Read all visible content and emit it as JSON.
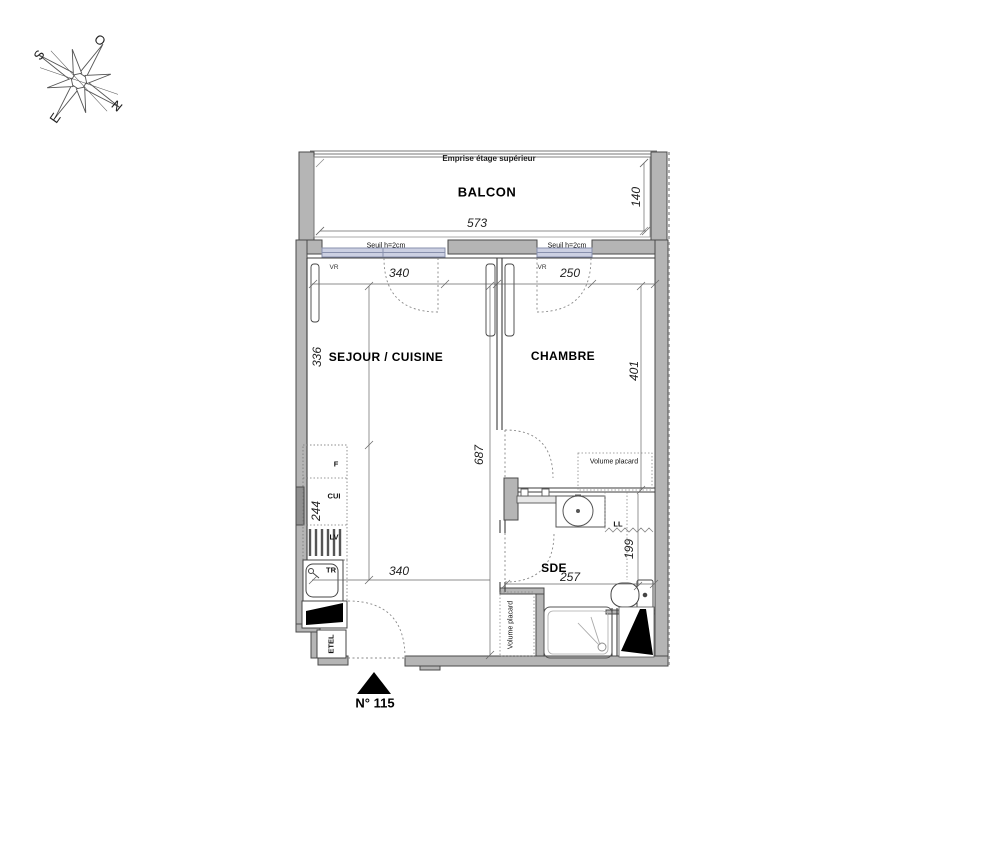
{
  "compass": {
    "n": "N",
    "s": "S",
    "e": "E",
    "o": "O"
  },
  "labels": {
    "upper_floor": "Emprise étage supérieur",
    "balcony": "BALCON",
    "threshold_left": "Seuil h=2cm",
    "threshold_right": "Seuil h=2cm",
    "shutter_left": "VR",
    "shutter_right": "VR",
    "living": "SEJOUR / CUISINE",
    "bedroom": "CHAMBRE",
    "bathroom": "SDE",
    "fridge": "F",
    "kitchen": "CUI",
    "dishwasher": "LV",
    "sink_unit": "TR",
    "washer": "LL",
    "closet_bedroom": "Volume placard",
    "closet_hall": "Volume placard",
    "duct": "ETEL",
    "unit_number": "N° 115"
  },
  "dimensions": {
    "balcony_width": "573",
    "balcony_depth": "140",
    "living_window": "340",
    "bedroom_window": "250",
    "living_top_height": "336",
    "bedroom_height": "401",
    "apartment_depth": "687",
    "kitchen_run": "244",
    "living_width": "340",
    "bathroom_width": "257",
    "bathroom_height": "199"
  },
  "colors": {
    "wall_fill": "#b5b5b5",
    "wall_dark": "#8f8f8f",
    "line": "#4a4a4a",
    "window_fill": "#ccd0e2",
    "window_border": "#8890ad",
    "dotted": "#999999",
    "door_leaf": "#000000"
  }
}
